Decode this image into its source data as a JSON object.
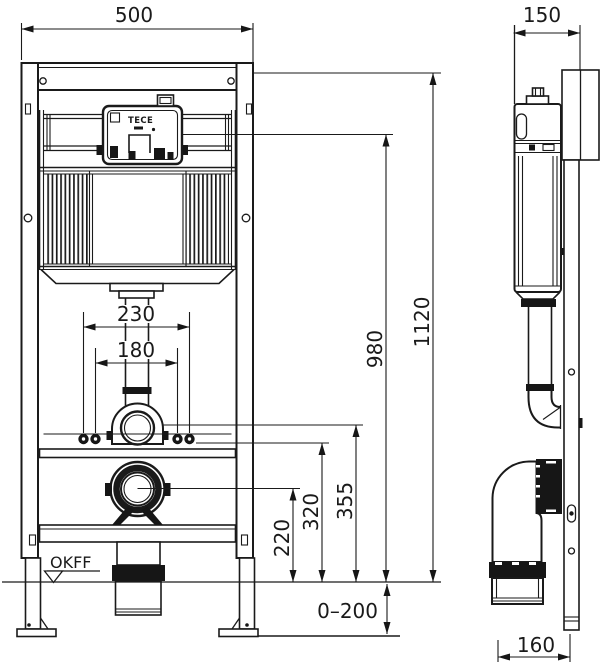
{
  "drawing": {
    "brand_label": "TECE",
    "floor_level_label": "OKFF",
    "dims": {
      "frame_width": "500",
      "frame_depth": "150",
      "total_height": "1120",
      "actuation_height": "980",
      "flush_pipe_height": "355",
      "fixing_rod_height": "320",
      "outlet_height": "220",
      "fixing_spacing_outer": "230",
      "fixing_spacing_inner": "180",
      "floor_adjustment": "0–200",
      "outlet_offset": "160"
    },
    "colors": {
      "line": "#1a1a1a",
      "background": "#ffffff"
    }
  }
}
